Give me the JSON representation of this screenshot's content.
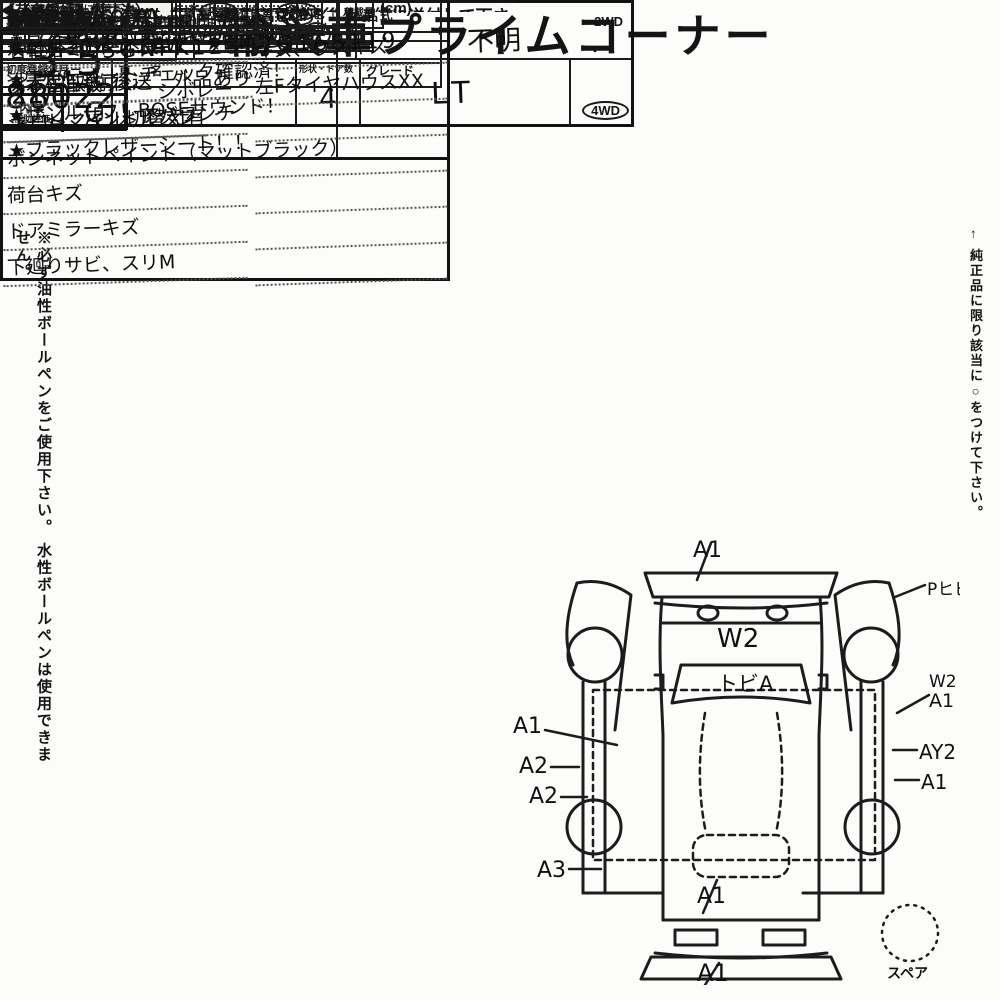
{
  "title": "輸入車プライムコーナー",
  "header": {
    "no_label": "No.",
    "no_value": "88022",
    "history_label": "車歴",
    "history_note": "（自家用以外は記入）",
    "displacement_label": "排気量",
    "displacement_value": "5300",
    "model_label": "型 式",
    "model_value": "不明",
    "first_reg_label": "初度登録年月",
    "first_reg_value": "21/1",
    "first_reg_unit": "月",
    "name_label": "車 名",
    "name_line1": "シボレー",
    "name_line2": "アバランチ",
    "shape_label": "形状・ドア数",
    "shape_value": "4",
    "grade_label": "グレード",
    "grade_value": "LT",
    "drive_2wd": "2WD",
    "drive_sep": "・",
    "drive_4wd": "4WD"
  },
  "score": {
    "check": "✓",
    "label": "評価点",
    "value": "3.5",
    "interior_line1": "内 装",
    "interior_line2": "補助評価",
    "interior_value": "C"
  },
  "margin_left": "※必ず油性ボールペンをご使用下さい。 水性ボールペンは使用できません。",
  "margin_right": "← 純正品に限り該当に○をつけて下さい。",
  "vehicle": {
    "shaken_label": "車検",
    "year_label": "年",
    "month_label": "月",
    "mileage_label": "走行",
    "mileage_d1": "1",
    "mileage_d2": "0",
    "mileage_d3": "0",
    "mileage_comma": ",",
    "mileage_d4": "3",
    "mileage_d5": "7",
    "mileage_d6": "6",
    "unit_km": "Km",
    "unit_mile": "マイル",
    "color_label_1": "外",
    "color_label_2": "色",
    "orig_color_label": "元色",
    "color_change_label": "色替",
    "orig_color_value": "ブラック →",
    "color_no_label": "カ ラ ー No.",
    "fuel_label_1": "燃",
    "fuel_label_2": "料",
    "fuel_pre": "ガ",
    "fuel_circled": "ソリ",
    "fuel_post": "ン・軽油・（　　　　）",
    "interior_color_label": "内 装 色",
    "import_label": "輸入車用",
    "year_type_label": "年式",
    "year_type_value": "2007",
    "import_class_label": "輸 入 区 分",
    "import_dealer": "ディーラー",
    "import_sep": "・",
    "import_parallel": "並行",
    "handle_label": "ハ ン ド ル",
    "handle_left": "左",
    "handle_sep": "・",
    "handle_right": "右"
  },
  "shift": {
    "label": "シフト",
    "value": "CAT"
  },
  "cooling": {
    "label": "冷 房",
    "value": "AAC"
  },
  "service_book": {
    "line1": "新車整備手帳",
    "line2": "（保証書付）",
    "value": "有 ・ 無"
  },
  "keep_note": "※書類と一緒に保管下さい。",
  "name_change": {
    "label": "名義変更期限",
    "month": "月",
    "day": "日"
  },
  "genuine": {
    "label": "純正品",
    "items": [
      {
        "text": "S R",
        "circled": true
      },
      {
        "text": "純AW",
        "circled": false
      },
      {
        "text": "P S",
        "circled": true
      },
      {
        "text": "P W",
        "circled": true
      },
      {
        "text": "カ ワ",
        "circled": true
      },
      {
        "text": "T V",
        "circled": false
      },
      {
        "text": "ナ ビ",
        "circled": false
      },
      {
        "text": "エアB",
        "circled": true
      }
    ]
  },
  "sales": {
    "title": "セールスポイント",
    "bullet": "★",
    "points": [
      "ユーザー買取車！4WD！",
      "実走行オートチェック確認済！",
      "サンルーフ！BOSEサウンド！",
      "ブラックレザーシート！！"
    ]
  },
  "recycle": {
    "label1": "リサイクル",
    "label2": "預託金",
    "value": "27,970",
    "unit": "円"
  },
  "capacity": {
    "label": "乗車定員",
    "value": "5",
    "unit": "人"
  },
  "payload": {
    "label": "積載量",
    "unit": "t"
  },
  "registration": {
    "reg_label": "登 録 No.",
    "chassis_label": "車 台 No.",
    "chassis_value": "3GNFK12397G168119",
    "serial_label": "シリアル No."
  },
  "notes": {
    "title": "◎注意事項",
    "subtitle": "（修復・不具合箇所および状態等）",
    "lines": [
      "★社外20インチAW　★ETC",
      "※本国取説 後送　外品あり",
      "キロ⇔マイル切替え有"
    ]
  },
  "report": {
    "title": "◎検査員報告",
    "subtitle": "（USS使用欄）",
    "rows": [
      {
        "left": "右電格ミラー不良",
        "right": "キズ、ウスキズ"
      },
      {
        "left": "ダッシュ板ワレ",
        "right": "左FタイヤハウスXX"
      },
      {
        "left": "シート、ハンドルスレ",
        "right": ""
      },
      {
        "left": "ボンネットペイント（マットブラック）",
        "right": ""
      },
      {
        "left": "荷台キズ",
        "right": ""
      },
      {
        "left": "ドアミラーキズ",
        "right": ""
      },
      {
        "left": "下廻りサビ、スリM",
        "right": ""
      }
    ]
  },
  "bed": {
    "title": "【荷台内寸】約",
    "x1": "×",
    "x2": "×",
    "cm_note": "(cm)",
    "len_label": "長さ",
    "wid_label": "幅",
    "hei_label": "高さ",
    "unit": "cm"
  },
  "diagram": {
    "top_a1": "A1",
    "p_crack": "Pヒビ",
    "hood": "W2",
    "windshield": "トビA",
    "left_1": "A1",
    "left_2": "A2",
    "left_3": "A2",
    "left_4": "A3",
    "right_w2": "W2",
    "right_a1": "A1",
    "right_ay2": "AY2",
    "right_a1b": "A1",
    "rear_a1": "A1",
    "bottom_a1": "A1",
    "spare": "スペア",
    "dims_note": "◀（車検証上の寸法）"
  },
  "bottom_note": "※キーレス・リモコン類は、名義変更完了後、一緒に送付して下さい。"
}
